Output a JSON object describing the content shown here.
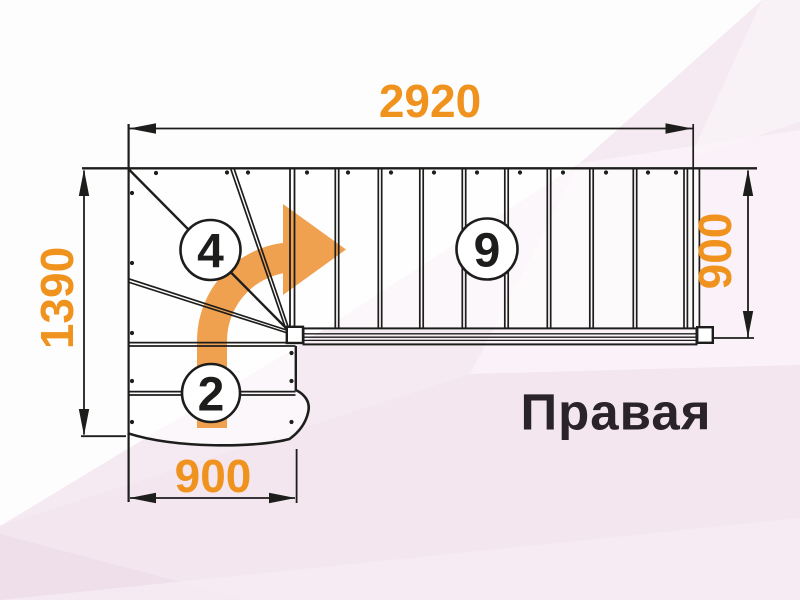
{
  "diagram": {
    "orientation_label": "Правая",
    "dimensions": {
      "top_width": "2920",
      "left_height": "1390",
      "right_height": "900",
      "bottom_width": "900"
    },
    "step_counts": {
      "winder_steps": "4",
      "upper_flight_steps": "9",
      "lower_flight_steps": "2"
    },
    "colors": {
      "dimension_orange": "#F0931E",
      "arrow_orange": "#F0A150",
      "line_black": "#1D1D1B",
      "label_dark": "#2A2328",
      "background_pink": "#F5EAF1"
    }
  }
}
